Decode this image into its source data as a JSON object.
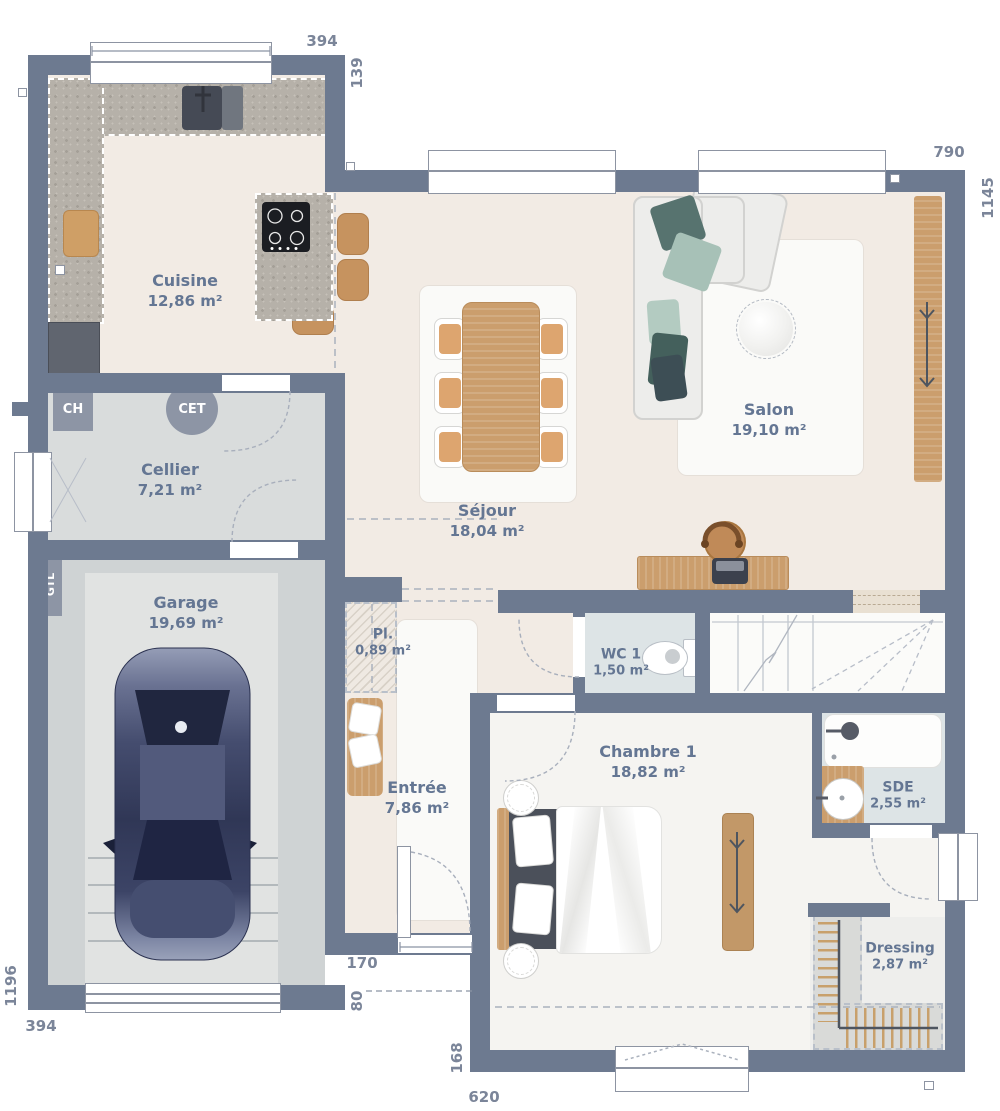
{
  "plan": {
    "rooms": [
      {
        "name": "Cuisine",
        "area": "12,86 m²"
      },
      {
        "name": "Cellier",
        "area": "7,21 m²"
      },
      {
        "name": "Garage",
        "area": "19,69 m²"
      },
      {
        "name": "Séjour",
        "area": "18,04 m²"
      },
      {
        "name": "Salon",
        "area": "19,10 m²"
      },
      {
        "name": "Pl.",
        "area": "0,89 m²"
      },
      {
        "name": "Entrée",
        "area": "7,86 m²"
      },
      {
        "name": "WC 1",
        "area": "1,50 m²"
      },
      {
        "name": "Chambre 1",
        "area": "18,82 m²"
      },
      {
        "name": "SDE",
        "area": "2,55 m²"
      },
      {
        "name": "Dressing",
        "area": "2,87 m²"
      }
    ],
    "equipment": {
      "water_heater": "CET",
      "boiler": "CH",
      "gtl": "GTL"
    },
    "dimensions_cm": {
      "kitchen_window": "394",
      "kitchen_side": "139",
      "living_top": "790",
      "right_side": "1145",
      "left_side": "1196",
      "garage_bottom": "394",
      "entry_door": "170",
      "entry_side": "80",
      "bedroom_side": "168",
      "bedroom_bottom": "620"
    },
    "colors": {
      "wall": "#6d7a90",
      "label": "#647693",
      "dim": "#7b8599",
      "badge": "#8d95a5",
      "floor_living": "#f2ebe4",
      "floor_bedroom": "#f5f4f1",
      "floor_utility": "#d9dcdc",
      "floor_garage": "#cfd3d4",
      "floor_garage_inner": "#e1e3e2",
      "floor_wet": "#dde4e6",
      "floor_dressing": "#eeeeec",
      "wood": "#cb9e6d",
      "sofa_pillow_dark": "#57736f",
      "sofa_pillow_sage": "#a7c1b7",
      "car_body": "#3a4160"
    }
  }
}
